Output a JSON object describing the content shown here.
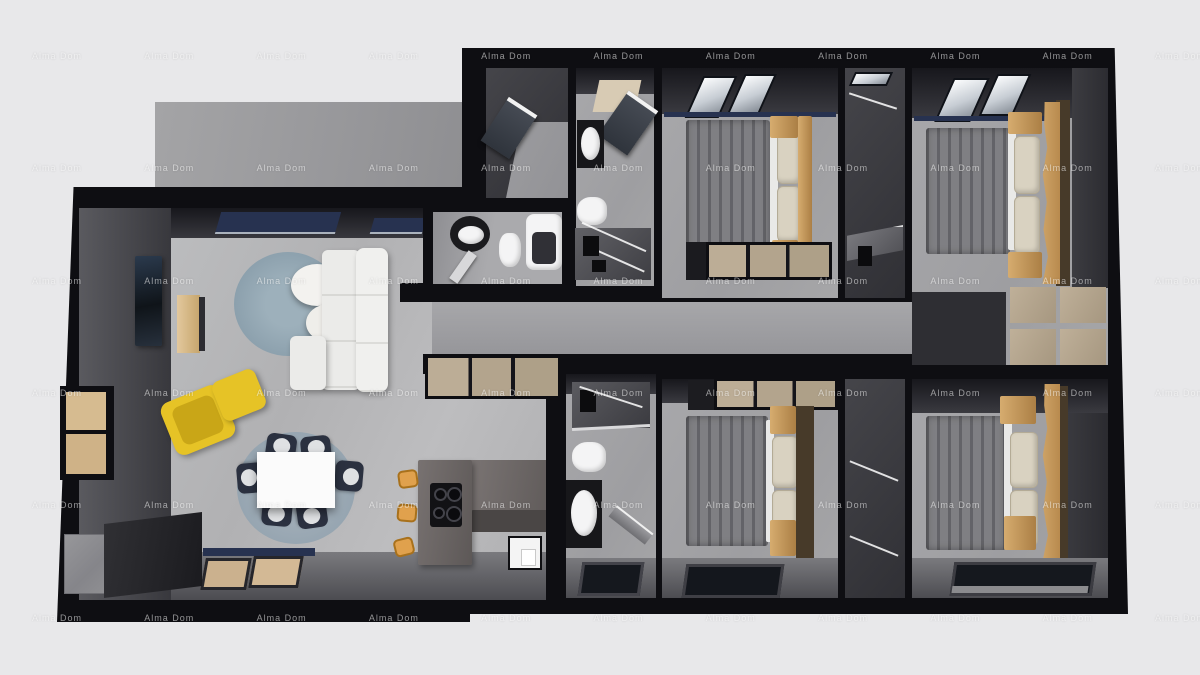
{
  "watermark": {
    "text": "Alma Dom",
    "color": "rgba(255,255,255,0.55)",
    "columns": 11,
    "rows": 6,
    "x_start": 57,
    "y_start": 56,
    "x_step": 112.3,
    "y_step": 112.3
  },
  "scene": {
    "type": "3d-rendered-floor-plan",
    "background_color": "#e8e8ea",
    "wall_color": "#0e0e12",
    "palette": {
      "living_floor": "#b5b5b7",
      "room_floor": "#a3a3a6",
      "corridor_floor": "#9e9ea1",
      "terrace_concrete": "#9c9c9f",
      "bed_blanket_gray": "#7f7f83",
      "pillow_beige": "#d9d2c1",
      "wood_light": "#c89b5f",
      "wardrobe_beige": "#b4a48d",
      "sofa_white": "#ebebe9",
      "rug_blue_gray": "#8fa3af",
      "armchair_yellow": "#e5c226",
      "stool_orange": "#e0a14d",
      "kitchen_island_gray": "#6e6968",
      "fixture_white": "#f4f4f5",
      "vanity_black": "#17171a"
    },
    "rooms": [
      {
        "name": "terrace",
        "furniture": []
      },
      {
        "name": "living-dining-kitchen",
        "furniture": [
          "wall-tv",
          "tv-sideboard",
          "round-rug",
          "coffee-table",
          "white-sofa",
          "yellow-armchair",
          "yellow-ottoman",
          "dining-rug",
          "dining-table",
          "dining-chairs-x6",
          "kitchen-island-with-cooktop",
          "bar-stools-x3",
          "kitchen-sink",
          "dark-counter",
          "stone-block"
        ]
      },
      {
        "name": "entry-hall",
        "furniture": [
          "entry-door"
        ]
      },
      {
        "name": "bathroom-small",
        "furniture": [
          "round-vanity-sink",
          "toilet",
          "bathtub",
          "door"
        ]
      },
      {
        "name": "bathroom-laundry",
        "furniture": [
          "doorway-mat",
          "door",
          "washbasin-unit",
          "toilet",
          "shower"
        ]
      },
      {
        "name": "bedroom-1",
        "furniture": [
          "double-bed",
          "wardrobe",
          "windows"
        ]
      },
      {
        "name": "walk-in-closet-1",
        "furniture": [
          "clothes-rail",
          "glass-shelf"
        ]
      },
      {
        "name": "bedroom-2",
        "furniture": [
          "double-bed",
          "live-edge-headboard",
          "wardrobe-2x2",
          "windows"
        ]
      },
      {
        "name": "corridor",
        "furniture": [
          "hall-cabinet"
        ]
      },
      {
        "name": "bathroom-2",
        "furniture": [
          "shower",
          "toilet",
          "vanity-sink",
          "door",
          "window"
        ]
      },
      {
        "name": "bedroom-3",
        "furniture": [
          "double-bed",
          "wardrobe",
          "window"
        ]
      },
      {
        "name": "walk-in-closet-2",
        "furniture": [
          "clothes-rail"
        ]
      },
      {
        "name": "bedroom-4",
        "furniture": [
          "double-bed",
          "live-edge-headboard",
          "window"
        ]
      }
    ]
  }
}
